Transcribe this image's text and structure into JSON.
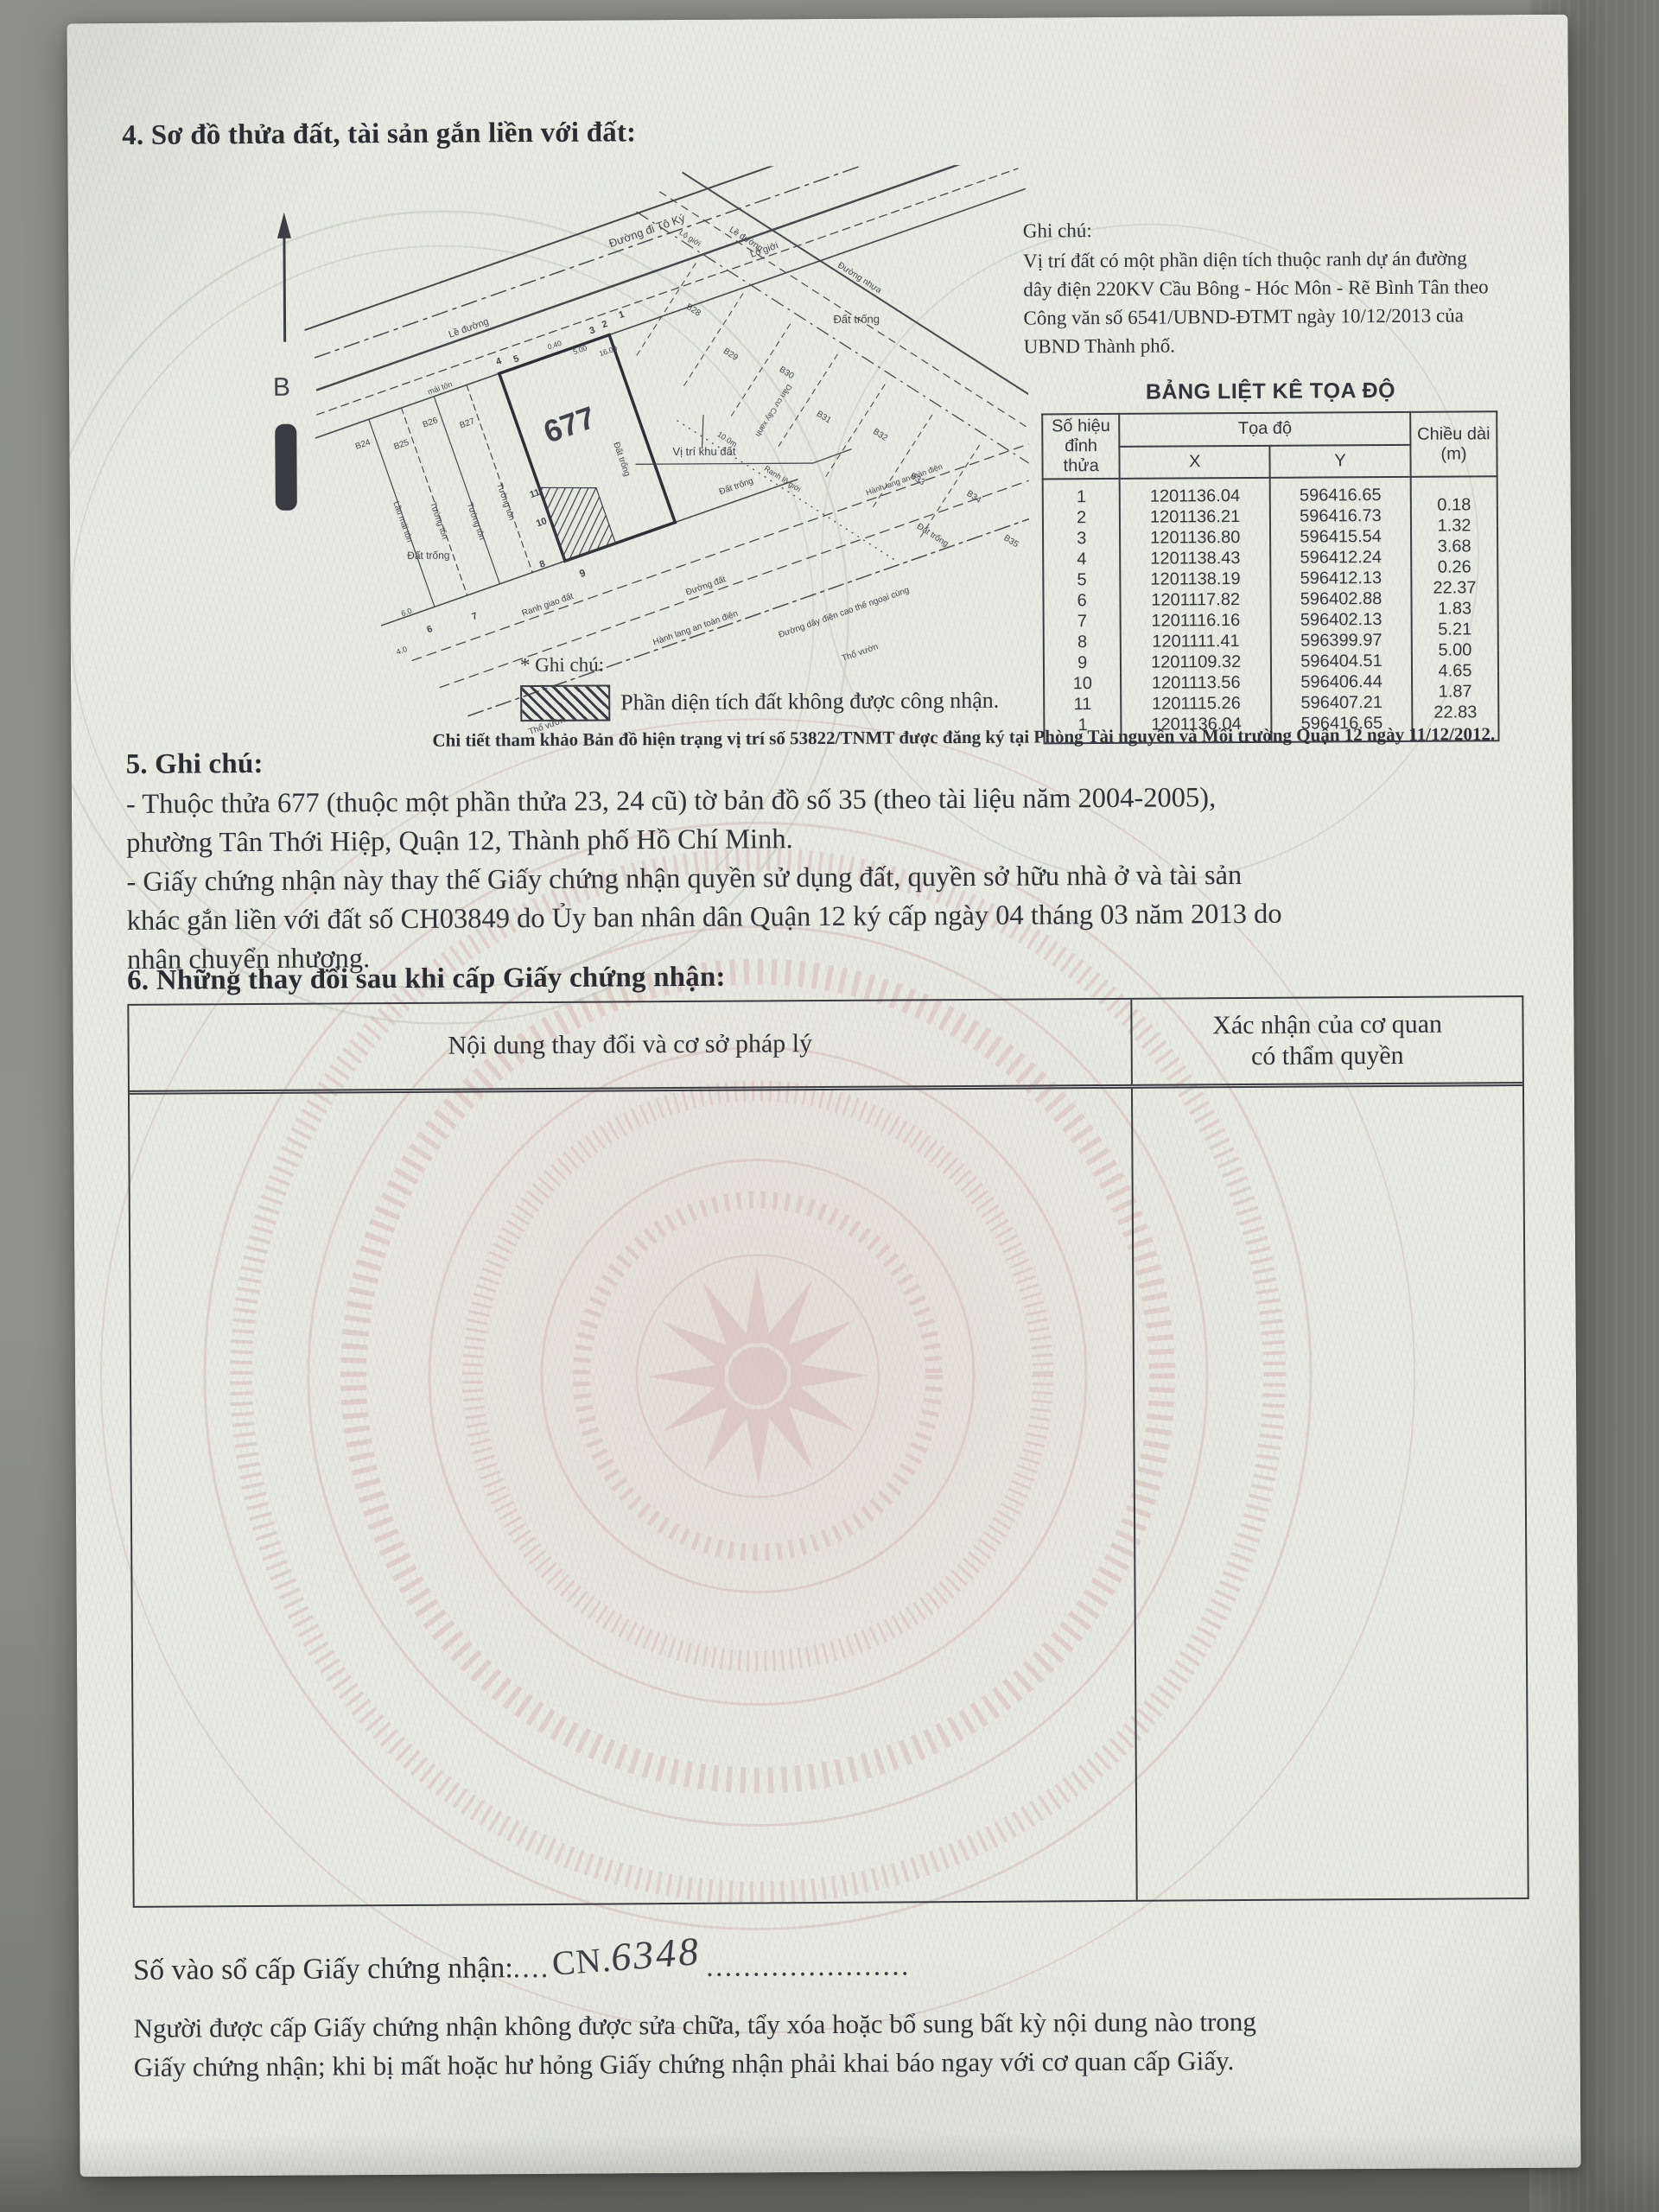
{
  "colors": {
    "paper": "#e9ebe3",
    "ink": "#30303a",
    "watermark_pink": "#d7b6b4",
    "watermark_green": "#b7c2b1",
    "concrete": "#8e8f89"
  },
  "section4": {
    "title": "4. Sơ đồ thửa đất, tài sản gắn liền với đất:"
  },
  "map": {
    "north_label": "B",
    "plot_number": "677",
    "plots": [
      "B24",
      "B25",
      "B26",
      "B27",
      "B28",
      "B29",
      "B30",
      "B31",
      "B32",
      "B33",
      "B34",
      "B35"
    ],
    "vertices": [
      "1",
      "2",
      "3",
      "4",
      "5",
      "6",
      "7",
      "8",
      "9",
      "10",
      "11"
    ],
    "labels": {
      "road_name": "Đường đi Tô Ký",
      "lo_gioi": "Lộ giới",
      "le_duong": "Lề đường",
      "duong_nhua": "Đường nhựa",
      "dat_trong": "Đất trống",
      "tho_vuon": "Thổ vườn",
      "tuong_ton": "Tường tôn",
      "lau_mai_ton": "Lầu mái tôn",
      "mai_ton": "mái tôn",
      "vi_tri_khu_dat": "Vị trí khu đất",
      "hanh_lang": "Hành lang an toàn điện",
      "duong_day": "Đường dây điện cao thế ngoại cùng",
      "ranh_giao_dat": "Ranh giao đất",
      "ranh_lo_gioi": "Ranh lộ giới",
      "duong_dat": "Đường đất",
      "dan_cu": "Dân cư Cây xanh"
    },
    "dims": {
      "d040": "0.40",
      "d500": "5.00",
      "d1600": "16.00",
      "d10m": "10.0m",
      "d60": "6.0",
      "d40": "4.0"
    }
  },
  "side_note": {
    "title": "Ghi chú:",
    "body_lines": [
      "Vị trí đất có một phần diện tích thuộc ranh dự án đường",
      "dây điện 220KV Cầu Bông - Hóc Môn - Rẽ Bình Tân theo",
      "Công văn số 6541/UBND-ĐTMT ngày 10/12/2013 của",
      "UBND Thành phố."
    ]
  },
  "coord_table": {
    "title": "BẢNG LIỆT KÊ TỌA ĐỘ",
    "col_vertex_1": "Số hiệu",
    "col_vertex_2": "đỉnh thửa",
    "col_coord": "Tọa độ",
    "col_x": "X",
    "col_y": "Y",
    "col_len_1": "Chiều dài",
    "col_len_2": "(m)",
    "rows": [
      {
        "v": "1",
        "x": "1201136.04",
        "y": "596416.65",
        "l": ""
      },
      {
        "v": "2",
        "x": "1201136.21",
        "y": "596416.73",
        "l": "0.18"
      },
      {
        "v": "3",
        "x": "1201136.80",
        "y": "596415.54",
        "l": "1.32"
      },
      {
        "v": "4",
        "x": "1201138.43",
        "y": "596412.24",
        "l": "3.68"
      },
      {
        "v": "5",
        "x": "1201138.19",
        "y": "596412.13",
        "l": "0.26"
      },
      {
        "v": "6",
        "x": "1201117.82",
        "y": "596402.88",
        "l": "22.37"
      },
      {
        "v": "7",
        "x": "1201116.16",
        "y": "596402.13",
        "l": "1.83"
      },
      {
        "v": "8",
        "x": "1201111.41",
        "y": "596399.97",
        "l": "5.21"
      },
      {
        "v": "9",
        "x": "1201109.32",
        "y": "596404.51",
        "l": "5.00"
      },
      {
        "v": "10",
        "x": "1201113.56",
        "y": "596406.44",
        "l": "4.65"
      },
      {
        "v": "11",
        "x": "1201115.26",
        "y": "596407.21",
        "l": "1.87"
      },
      {
        "v": "1",
        "x": "1201136.04",
        "y": "596416.65",
        "l": "22.83"
      }
    ]
  },
  "legend": {
    "title": "* Ghi chú:",
    "hatch_label": "Phần diện tích đất không được công nhận.",
    "detail": "Chi tiết tham khảo Bản đồ hiện trạng vị trí số 53822/TNMT được đăng ký tại Phòng Tài nguyên và Môi trường Quận 12 ngày 11/12/2012."
  },
  "section5": {
    "title": "5. Ghi chú:",
    "item1_lines": [
      "- Thuộc thửa 677 (thuộc một phần thửa 23, 24 cũ) tờ bản đồ số 35 (theo tài liệu năm 2004-2005),",
      "phường Tân Thới Hiệp, Quận 12, Thành phố Hồ Chí Minh."
    ],
    "item2_lines": [
      "- Giấy chứng nhận này thay thế Giấy chứng nhận quyền sử dụng đất, quyền sở hữu nhà ở và tài sản",
      "khác gắn liền với đất số CH03849 do Ủy ban nhân dân Quận 12 ký cấp ngày 04 tháng 03 năm 2013 do",
      "nhận chuyển nhượng."
    ]
  },
  "section6": {
    "title": "6. Những thay đổi sau khi cấp Giấy chứng nhận:",
    "col1": "Nội dung thay đổi và cơ sở pháp lý",
    "col2_line1": "Xác nhận của cơ quan",
    "col2_line2": "có thẩm quyền"
  },
  "footer": {
    "register_label": "Số vào sổ cấp Giấy chứng nhận:",
    "register_dots_pre": "....",
    "register_cn": "CN.",
    "register_number": "6348",
    "register_dots_post": "......................",
    "note_lines": [
      "Người được cấp Giấy chứng nhận không được sửa chữa, tẩy xóa hoặc bổ sung bất kỳ nội dung nào trong",
      "Giấy chứng nhận; khi bị mất hoặc hư hỏng Giấy chứng nhận phải khai báo ngay với cơ quan cấp Giấy."
    ]
  }
}
